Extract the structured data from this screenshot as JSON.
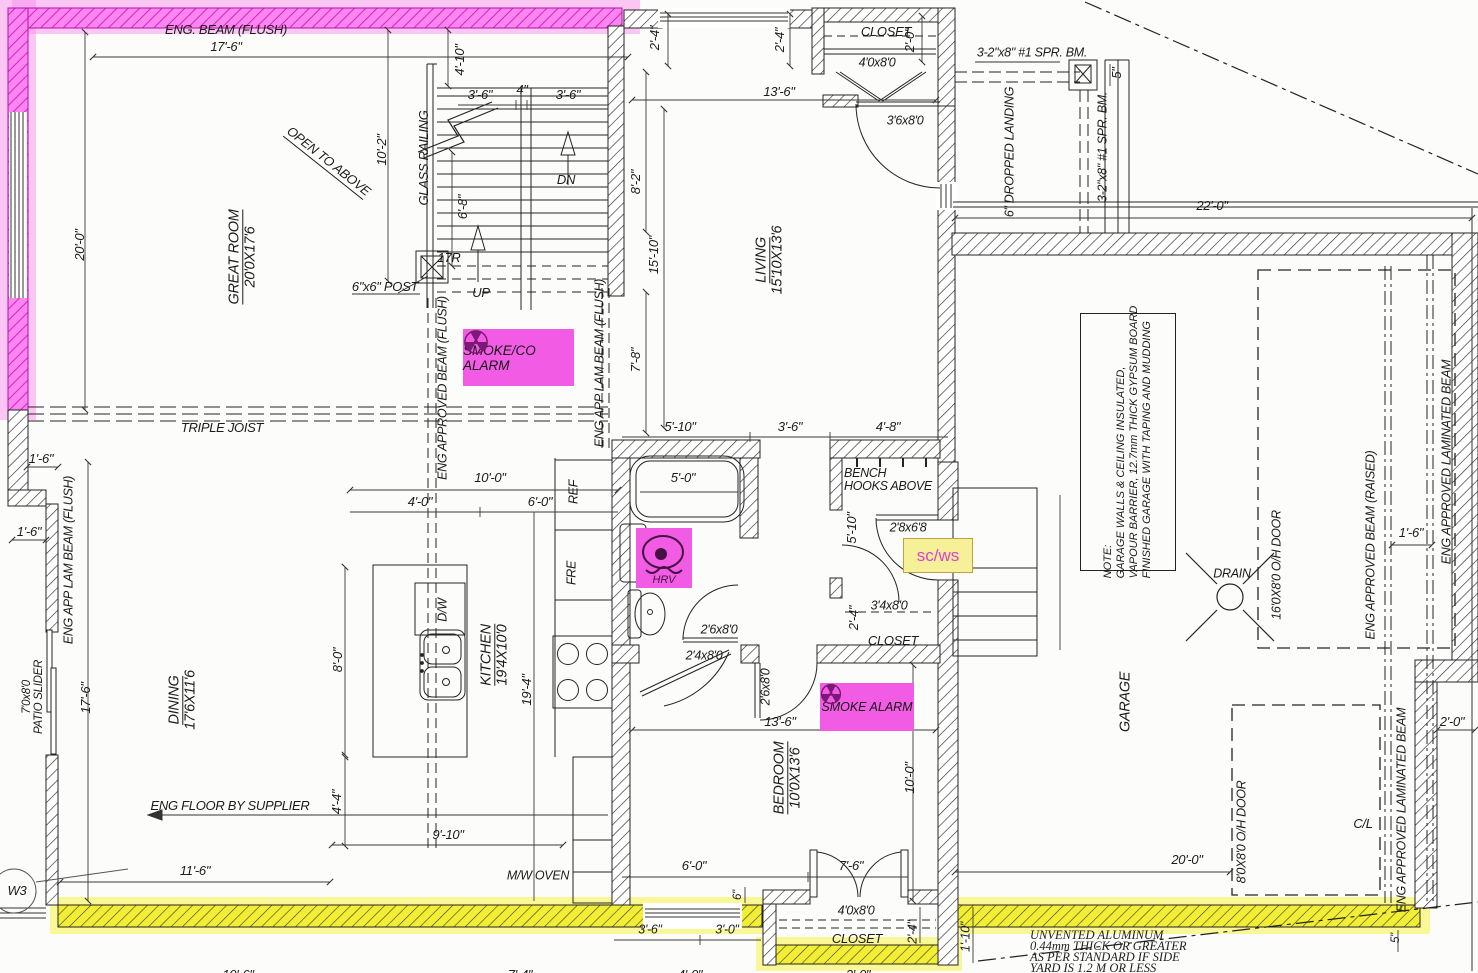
{
  "colors": {
    "magenta_highlight": "#f25ce5",
    "yellow_highlight": "#f2ee35",
    "line": "#242424"
  },
  "rooms": {
    "great_room": {
      "name": "GREAT ROOM",
      "size": "20'0X17'6"
    },
    "living": {
      "name": "LIVING",
      "size": "15'10X13'6"
    },
    "kitchen": {
      "name": "KITCHEN",
      "size": "19'4X10'0"
    },
    "dining": {
      "name": "DINING",
      "size": "17'6X11'6"
    },
    "bedroom": {
      "name": "BEDROOM",
      "size": "10'0X13'6"
    },
    "garage": {
      "name": "GARAGE"
    },
    "closet": "CLOSET"
  },
  "alarms": {
    "smoke_co": "SMOKE/CO ALARM",
    "smoke": "SMOKE ALARM",
    "sc_ws": "sc/ws",
    "hrv": "HRV"
  },
  "beams": {
    "eng_beam_flush": "ENG. BEAM (FLUSH)",
    "triple_joist": "TRIPLE JOIST",
    "eng_approved_beam_flush": "ENG APPROVED BEAM (FLUSH)",
    "eng_app_lam_beam_flush": "ENG APP LAM BEAM (FLUSH)",
    "spr_bm": "3-2\"x8\" #1 SPR. BM.",
    "eng_approved_beam_raised": "ENG APPROVED BEAM (RAISED)",
    "eng_approved_laminated_beam": "ENG APPROVED LAMINATED BEAM",
    "eng_floor_by_supplier": "ENG FLOOR BY SUPPLIER"
  },
  "stairs": {
    "glass_railing": "GLASS RAILING",
    "open_to_above": "OPEN TO ABOVE",
    "dn": "DN",
    "up": "UP",
    "risers": "17R",
    "post": "6\"x6\" POST",
    "dropped_landing": "6\" DROPPED LANDING"
  },
  "fixtures": {
    "ref": "REF",
    "fre": "FRE",
    "dw": "D/W",
    "mw_oven": "M/W OVEN",
    "drain": "DRAIN",
    "bench": "BENCH",
    "hooks_above": "HOOKS ABOVE",
    "patio_size": "7'0x8'0",
    "patio": "PATIO SLIDER",
    "w3": "W3",
    "cl": "C/L"
  },
  "doors": {
    "oh16": "16'0X8'0 O/H DOOR",
    "oh8": "8'0X8'0 O/H DOOR",
    "s4080": "4'0x8'0",
    "s3680": "3'6x8'0",
    "s2868": "2'8x6'8",
    "s2680": "2'6x8'0",
    "s2480": "2'4x8'0",
    "s3480": "3'4x8'0"
  },
  "dims": {
    "d17_6": "17'-6\"",
    "d20_0": "20'-0\"",
    "d10_2": "10'-2\"",
    "d4_10": "4'-10\"",
    "d3_6": "3'-6\"",
    "d4": "4\"",
    "d6_8": "6'-8\"",
    "d2_4": "2'-4\"",
    "d2_0": "2'-0\"",
    "d13_6": "13'-6\"",
    "d8_2": "8'-2\"",
    "d15_10": "15'-10\"",
    "d7_8": "7'-8\"",
    "d5": "5\"",
    "d22_0": "22'-0\"",
    "d1_6": "1'-6\"",
    "d5_10": "5'-10\"",
    "d4_8": "4'-8\"",
    "d10_0": "10'-0\"",
    "d4_0": "4'-0\"",
    "d6_0": "6'-0\"",
    "d8_0": "8'-0\"",
    "d19_4": "19'-4\"",
    "d5_0": "5'-0\"",
    "d4_4": "4'-4\"",
    "d9_10": "9'-10\"",
    "d11_6": "11'-6\"",
    "d7_6": "7'-6\"",
    "d3_0": "3'-0\"",
    "d6": "6\"",
    "d1_10": "1'-10\""
  },
  "partial_dims": {
    "p1": "10'-6\"",
    "p2": "7'-4\"",
    "p3": "4'-0\"",
    "p4": "3'-0\""
  },
  "notes": {
    "garage": {
      "l1": "NOTE:",
      "l2": "GARAGE WALLS & CEILING INSULATED,",
      "l3": "VAPOUR BARRIER, 12.7mm THICK GYPSUM BOARD",
      "l4": "FINISHED GARAGE WITH TAPING AND MUDDING"
    },
    "aluminum": {
      "l1": "UNVENTED ALUMINUM",
      "l2": "0.44mm THICK OR GREATER",
      "l3": "AS PER STANDARD IF SIDE",
      "l4": "YARD IS 1.2 M OR LESS"
    }
  }
}
